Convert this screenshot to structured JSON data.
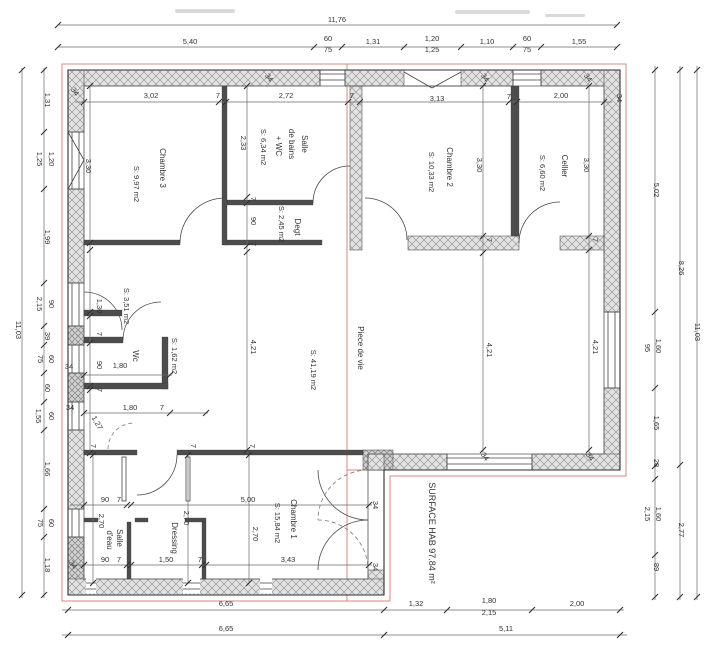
{
  "drawing": {
    "total_surface": "SURFACE HAB 97.84 m²",
    "overall_width": "11,76",
    "overall_height": "11,03",
    "rooms": [
      {
        "name": "Chambre 3",
        "area": "S: 9,97 m2"
      },
      {
        "name": "Salle de bains + WC",
        "area": "S: 6,34 m2"
      },
      {
        "name": "Degt",
        "area": "S: 2,45 m2"
      },
      {
        "name": "Chambre 2",
        "area": "S: 10,33 m2"
      },
      {
        "name": "Cellier",
        "area": "S: 6,60 m2"
      },
      {
        "name": "Wc",
        "area": "S: 1,62 m2"
      },
      {
        "name": "",
        "area": "S: 3,51 m2"
      },
      {
        "name": "Piece de vie",
        "area": "S: 41,19 m2"
      },
      {
        "name": "Chambre 1",
        "area": "S: 15,84 m2"
      },
      {
        "name": "Dressing",
        "area": ""
      },
      {
        "name": "Salle d'eau",
        "area": ""
      }
    ]
  },
  "labels": [
    {
      "t": "11,76",
      "x": 337,
      "y": 22,
      "r": 0,
      "c": "dim"
    },
    {
      "t": "5,40",
      "x": 190,
      "y": 44,
      "r": 0,
      "c": "dim"
    },
    {
      "t": "60",
      "x": 328,
      "y": 41,
      "r": 0,
      "c": "dim"
    },
    {
      "t": "75",
      "x": 328,
      "y": 52,
      "r": 0,
      "c": "dim"
    },
    {
      "t": "1,31",
      "x": 373,
      "y": 44,
      "r": 0,
      "c": "dim"
    },
    {
      "t": "1,20",
      "x": 432,
      "y": 41,
      "r": 0,
      "c": "dim"
    },
    {
      "t": "1,25",
      "x": 432,
      "y": 52,
      "r": 0,
      "c": "dim"
    },
    {
      "t": "1,10",
      "x": 487,
      "y": 44,
      "r": 0,
      "c": "dim"
    },
    {
      "t": "60",
      "x": 527,
      "y": 41,
      "r": 0,
      "c": "dim"
    },
    {
      "t": "75",
      "x": 527,
      "y": 52,
      "r": 0,
      "c": "dim"
    },
    {
      "t": "1,55",
      "x": 579,
      "y": 44,
      "r": 0,
      "c": "dim"
    },
    {
      "t": "3,02",
      "x": 151,
      "y": 98,
      "r": 0,
      "c": "dim"
    },
    {
      "t": "7",
      "x": 218,
      "y": 98,
      "r": 0,
      "c": "dim"
    },
    {
      "t": "2,72",
      "x": 286,
      "y": 98,
      "r": 0,
      "c": "dim"
    },
    {
      "t": "7",
      "x": 352,
      "y": 98,
      "r": 0,
      "c": "dim"
    },
    {
      "t": "3,13",
      "x": 437,
      "y": 101,
      "r": 0,
      "c": "dim"
    },
    {
      "t": "7",
      "x": 509,
      "y": 99,
      "r": 0,
      "c": "dim"
    },
    {
      "t": "2,00",
      "x": 561,
      "y": 98,
      "r": 0,
      "c": "dim"
    },
    {
      "t": "34",
      "x": 617,
      "y": 98,
      "r": 90,
      "c": "dim"
    },
    {
      "t": "34",
      "x": 73,
      "y": 93,
      "r": 55,
      "c": "dim"
    },
    {
      "t": "34",
      "x": 267,
      "y": 79,
      "r": 55,
      "c": "dim"
    },
    {
      "t": "34",
      "x": 483,
      "y": 79,
      "r": 55,
      "c": "dim"
    },
    {
      "t": "34",
      "x": 586,
      "y": 79,
      "r": 55,
      "c": "dim"
    },
    {
      "t": "11,03",
      "x": 16,
      "y": 330,
      "r": 90,
      "c": "dim"
    },
    {
      "t": "1,31",
      "x": 45,
      "y": 100,
      "r": 90,
      "c": "dim"
    },
    {
      "t": "1,20",
      "x": 49,
      "y": 159,
      "r": 90,
      "c": "dim"
    },
    {
      "t": "1,25",
      "x": 37,
      "y": 159,
      "r": 90,
      "c": "dim"
    },
    {
      "t": "1,99",
      "x": 45,
      "y": 237,
      "r": 90,
      "c": "dim"
    },
    {
      "t": "90",
      "x": 49,
      "y": 304,
      "r": 90,
      "c": "dim"
    },
    {
      "t": "2,15",
      "x": 37,
      "y": 304,
      "r": 90,
      "c": "dim"
    },
    {
      "t": "39",
      "x": 45,
      "y": 336,
      "r": 90,
      "c": "dim"
    },
    {
      "t": "60",
      "x": 49,
      "y": 359,
      "r": 90,
      "c": "dim"
    },
    {
      "t": "75",
      "x": 38,
      "y": 359,
      "r": 90,
      "c": "dim"
    },
    {
      "t": "60",
      "x": 45,
      "y": 388,
      "r": 90,
      "c": "dim"
    },
    {
      "t": "60",
      "x": 49,
      "y": 416,
      "r": 90,
      "c": "dim"
    },
    {
      "t": "1,55",
      "x": 36,
      "y": 416,
      "r": 90,
      "c": "dim"
    },
    {
      "t": "1,66",
      "x": 45,
      "y": 469,
      "r": 90,
      "c": "dim"
    },
    {
      "t": "60",
      "x": 49,
      "y": 523,
      "r": 90,
      "c": "dim"
    },
    {
      "t": "75",
      "x": 38,
      "y": 523,
      "r": 90,
      "c": "dim"
    },
    {
      "t": "1,18",
      "x": 45,
      "y": 565,
      "r": 90,
      "c": "dim"
    },
    {
      "t": "5,02",
      "x": 654,
      "y": 190,
      "r": 90,
      "c": "dim"
    },
    {
      "t": "95",
      "x": 645,
      "y": 348,
      "r": 90,
      "c": "dim"
    },
    {
      "t": "1,60",
      "x": 656,
      "y": 346,
      "r": 90,
      "c": "dim"
    },
    {
      "t": "1,65",
      "x": 654,
      "y": 423,
      "r": 90,
      "c": "dim"
    },
    {
      "t": "28",
      "x": 654,
      "y": 463,
      "r": 90,
      "c": "dim"
    },
    {
      "t": "1,60",
      "x": 656,
      "y": 514,
      "r": 90,
      "c": "dim"
    },
    {
      "t": "2,15",
      "x": 645,
      "y": 514,
      "r": 90,
      "c": "dim"
    },
    {
      "t": "89",
      "x": 654,
      "y": 567,
      "r": 90,
      "c": "dim"
    },
    {
      "t": "8,26",
      "x": 679,
      "y": 268,
      "r": 90,
      "c": "dim"
    },
    {
      "t": "2,77",
      "x": 679,
      "y": 530,
      "r": 90,
      "c": "dim"
    },
    {
      "t": "11,03",
      "x": 695,
      "y": 332,
      "r": 90,
      "c": "dim"
    },
    {
      "t": "6,65",
      "x": 226,
      "y": 606,
      "r": 0,
      "c": "dim"
    },
    {
      "t": "6,65",
      "x": 226,
      "y": 631,
      "r": 0,
      "c": "dim"
    },
    {
      "t": "1,32",
      "x": 416,
      "y": 606,
      "r": 0,
      "c": "dim"
    },
    {
      "t": "1,80",
      "x": 489,
      "y": 603,
      "r": 0,
      "c": "dim"
    },
    {
      "t": "2,15",
      "x": 489,
      "y": 615,
      "r": 0,
      "c": "dim"
    },
    {
      "t": "2,00",
      "x": 577,
      "y": 606,
      "r": 0,
      "c": "dim"
    },
    {
      "t": "5,11",
      "x": 506,
      "y": 631,
      "r": 0,
      "c": "dim"
    },
    {
      "t": "Chambre 3",
      "x": 160,
      "y": 168,
      "r": 90,
      "c": "room",
      "n": "room-label-chambre-3"
    },
    {
      "t": "S: 9,97 m2",
      "x": 134,
      "y": 184,
      "r": 90,
      "c": "area",
      "n": "room-area-chambre-3"
    },
    {
      "t": "3,30",
      "x": 86,
      "y": 166,
      "r": 90,
      "c": "dim"
    },
    {
      "t": "Salle",
      "x": 302,
      "y": 144,
      "r": 90,
      "c": "room",
      "n": "room-label-salle-de-bains"
    },
    {
      "t": "de bains",
      "x": 289,
      "y": 144,
      "r": 90,
      "c": "room"
    },
    {
      "t": "+ WC",
      "x": 276,
      "y": 146,
      "r": 90,
      "c": "room"
    },
    {
      "t": "S: 6,34 m2",
      "x": 261,
      "y": 147,
      "r": 90,
      "c": "area",
      "n": "room-area-salle-de-bains"
    },
    {
      "t": "2,33",
      "x": 241,
      "y": 143,
      "r": 90,
      "c": "dim"
    },
    {
      "t": "Degt",
      "x": 295,
      "y": 227,
      "r": 90,
      "c": "room",
      "n": "room-label-degt"
    },
    {
      "t": "S: 2,45 m2",
      "x": 279,
      "y": 224,
      "r": 90,
      "c": "area",
      "n": "room-area-degt"
    },
    {
      "t": "7",
      "x": 251,
      "y": 199,
      "r": 90,
      "c": "dim"
    },
    {
      "t": "90",
      "x": 251,
      "y": 221,
      "r": 90,
      "c": "dim"
    },
    {
      "t": "7",
      "x": 251,
      "y": 244,
      "r": 90,
      "c": "dim"
    },
    {
      "t": "Chambre 2",
      "x": 447,
      "y": 167,
      "r": 90,
      "c": "room",
      "n": "room-label-chambre-2"
    },
    {
      "t": "S: 10,33 m2",
      "x": 429,
      "y": 172,
      "r": 90,
      "c": "area",
      "n": "room-area-chambre-2"
    },
    {
      "t": "3,30",
      "x": 477,
      "y": 165,
      "r": 90,
      "c": "dim"
    },
    {
      "t": "Cellier",
      "x": 562,
      "y": 166,
      "r": 90,
      "c": "room",
      "n": "room-label-cellier"
    },
    {
      "t": "S: 6,60 m2",
      "x": 540,
      "y": 173,
      "r": 90,
      "c": "area",
      "n": "room-area-cellier"
    },
    {
      "t": "3,30",
      "x": 584,
      "y": 165,
      "r": 90,
      "c": "dim"
    },
    {
      "t": "7",
      "x": 487,
      "y": 240,
      "r": 90,
      "c": "dim"
    },
    {
      "t": "7",
      "x": 593,
      "y": 240,
      "r": 90,
      "c": "dim"
    },
    {
      "t": "S: 3,51 m2",
      "x": 124,
      "y": 306,
      "r": 90,
      "c": "area",
      "n": "room-area-couloir"
    },
    {
      "t": "1,30",
      "x": 97,
      "y": 306,
      "r": 90,
      "c": "dim"
    },
    {
      "t": "7",
      "x": 97,
      "y": 334,
      "r": 90,
      "c": "dim"
    },
    {
      "t": "90",
      "x": 97,
      "y": 365,
      "r": 90,
      "c": "dim"
    },
    {
      "t": "7",
      "x": 97,
      "y": 390,
      "r": 90,
      "c": "dim"
    },
    {
      "t": "Wc",
      "x": 133,
      "y": 356,
      "r": 90,
      "c": "room",
      "n": "room-label-wc"
    },
    {
      "t": "S: 1,62 m2",
      "x": 172,
      "y": 356,
      "r": 90,
      "c": "area",
      "n": "room-area-wc"
    },
    {
      "t": "1,80",
      "x": 120,
      "y": 368,
      "r": 0,
      "c": "dim"
    },
    {
      "t": "34",
      "x": 69,
      "y": 369,
      "r": 0,
      "c": "dim"
    },
    {
      "t": "34",
      "x": 70,
      "y": 410,
      "r": 0,
      "c": "dim"
    },
    {
      "t": "1,80",
      "x": 130,
      "y": 410,
      "r": 0,
      "c": "dim"
    },
    {
      "t": "7",
      "x": 162,
      "y": 410,
      "r": 0,
      "c": "dim"
    },
    {
      "t": "1,27",
      "x": 95,
      "y": 424,
      "r": 60,
      "c": "dim"
    },
    {
      "t": "Piece de vie",
      "x": 358,
      "y": 348,
      "r": 90,
      "c": "room",
      "n": "room-label-piece-de-vie"
    },
    {
      "t": "S: 41,19 m2",
      "x": 311,
      "y": 370,
      "r": 90,
      "c": "area",
      "n": "room-area-piece-de-vie"
    },
    {
      "t": "4,21",
      "x": 251,
      "y": 347,
      "r": 90,
      "c": "dim"
    },
    {
      "t": "4,21",
      "x": 487,
      "y": 350,
      "r": 90,
      "c": "dim"
    },
    {
      "t": "4,21",
      "x": 593,
      "y": 347,
      "r": 90,
      "c": "dim"
    },
    {
      "t": "7",
      "x": 91,
      "y": 446,
      "r": 90,
      "c": "dim"
    },
    {
      "t": "7",
      "x": 191,
      "y": 446,
      "r": 90,
      "c": "dim"
    },
    {
      "t": "7",
      "x": 250,
      "y": 446,
      "r": 90,
      "c": "dim"
    },
    {
      "t": "34",
      "x": 483,
      "y": 458,
      "r": 55,
      "c": "dim"
    },
    {
      "t": "34",
      "x": 588,
      "y": 458,
      "r": 55,
      "c": "dim"
    },
    {
      "t": "90",
      "x": 105,
      "y": 502,
      "r": 0,
      "c": "dim"
    },
    {
      "t": "7",
      "x": 119,
      "y": 502,
      "r": 0,
      "c": "dim"
    },
    {
      "t": "5,00",
      "x": 248,
      "y": 502,
      "r": 0,
      "c": "dim"
    },
    {
      "t": "2,70",
      "x": 99,
      "y": 521,
      "r": 90,
      "c": "dim"
    },
    {
      "t": "Salle",
      "x": 117,
      "y": 538,
      "r": 90,
      "c": "room",
      "n": "room-label-salle-d-eau"
    },
    {
      "t": "d'eau",
      "x": 107,
      "y": 540,
      "r": 90,
      "c": "room"
    },
    {
      "t": "Dressing",
      "x": 172,
      "y": 538,
      "r": 90,
      "c": "room",
      "n": "room-label-dressing"
    },
    {
      "t": "2,70",
      "x": 184,
      "y": 518,
      "r": 90,
      "c": "dim"
    },
    {
      "t": "2,70",
      "x": 253,
      "y": 534,
      "r": 90,
      "c": "dim"
    },
    {
      "t": "Chambre 1",
      "x": 291,
      "y": 519,
      "r": 90,
      "c": "room",
      "n": "room-label-chambre-1"
    },
    {
      "t": "S: 15,84 m2",
      "x": 275,
      "y": 523,
      "r": 90,
      "c": "area",
      "n": "room-area-chambre-1"
    },
    {
      "t": "90",
      "x": 105,
      "y": 562,
      "r": 0,
      "c": "dim"
    },
    {
      "t": "7",
      "x": 119,
      "y": 562,
      "r": 0,
      "c": "dim"
    },
    {
      "t": "1,50",
      "x": 166,
      "y": 562,
      "r": 0,
      "c": "dim"
    },
    {
      "t": "7",
      "x": 200,
      "y": 562,
      "r": 0,
      "c": "dim"
    },
    {
      "t": "3,43",
      "x": 288,
      "y": 562,
      "r": 0,
      "c": "dim"
    },
    {
      "t": "34",
      "x": 71,
      "y": 566,
      "r": 55,
      "c": "dim"
    },
    {
      "t": "34",
      "x": 373,
      "y": 505,
      "r": 90,
      "c": "dim"
    },
    {
      "t": "34",
      "x": 373,
      "y": 567,
      "r": 90,
      "c": "dim"
    },
    {
      "t": "SURFACE HAB 97.84 m²",
      "x": 429,
      "y": 533,
      "r": 90,
      "c": "surf",
      "n": "surface-total-label"
    }
  ]
}
